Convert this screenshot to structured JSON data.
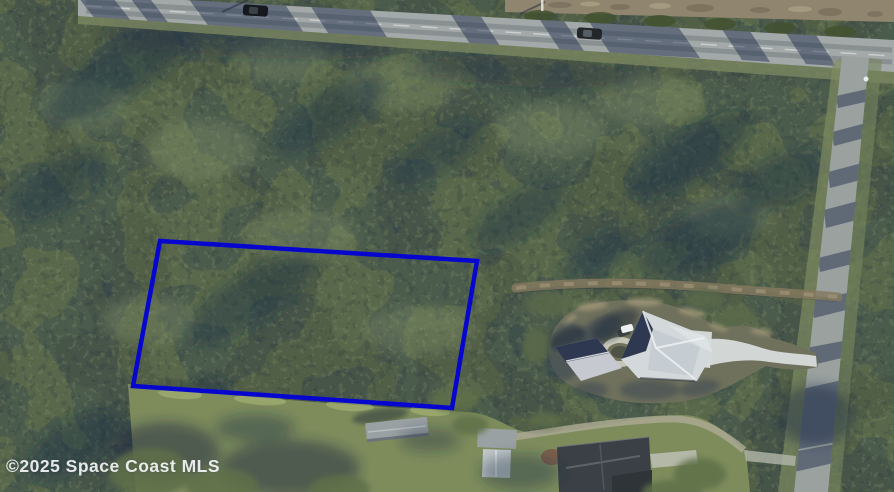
{
  "scene": {
    "type": "aerial-photograph",
    "description": "Aerial MLS photo of a wooded vacant lot outlined in blue, with a highway at top, a residential street at right, a neighboring house with circular driveway, and outbuildings in a grass clearing at bottom"
  },
  "watermark": {
    "text": "©2025 Space Coast MLS",
    "color": "#ffffff"
  },
  "property_boundary": {
    "shape": "quadrilateral",
    "points": "160,241 477,261 452,408 133,386",
    "color": "#0606cf",
    "stroke_width": 4.5
  },
  "colors": {
    "forest_base": "#4e5c45",
    "forest_shadow": "#22304a",
    "canopy_light": "#87976d",
    "highway_asphalt": "#a3a8a8",
    "street_asphalt": "#9aa19f",
    "driveway_concrete": "#d7dbdb",
    "lawn": "#70715c",
    "clearing_grass": "#7e8c5c",
    "dirt_strip": "#90856e",
    "house_roof_light": "#d3d8db",
    "house_roof_shadow": "#2e3850",
    "outbuilding_roof": "#9aa1a3",
    "dark_roof": "#3a4045",
    "red_dirt_patch": "#7d5b49"
  },
  "vehicles": [
    {
      "name": "car on highway (west)",
      "color": "#15181c"
    },
    {
      "name": "car on highway (east)",
      "color": "#23272c"
    },
    {
      "name": "white car at house",
      "color": "#edf0f1"
    }
  ]
}
